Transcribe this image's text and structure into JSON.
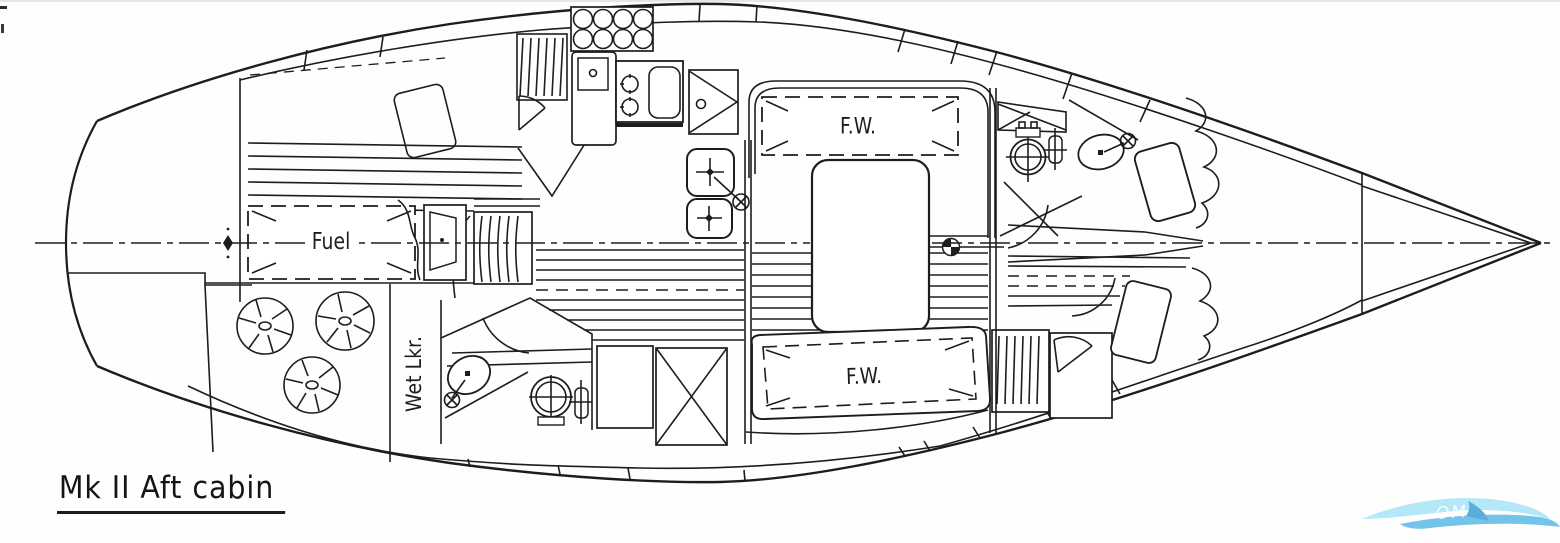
{
  "drawing": {
    "title": "Mk II Aft cabin",
    "labels": {
      "fuel": "Fuel",
      "fresh_water_upper": "F.W.",
      "fresh_water_lower": "F.W.",
      "wet_locker": "Wet Lkr."
    },
    "colors": {
      "ink": "#1d1d1d",
      "paper": "#ffffff",
      "watermark_light": "#a8e4f7",
      "watermark_mid": "#5bb9e8",
      "watermark_sail": "#3f9fd9"
    },
    "watermark": {
      "icon": "wave-swoosh-watermark",
      "text": "OM"
    }
  }
}
